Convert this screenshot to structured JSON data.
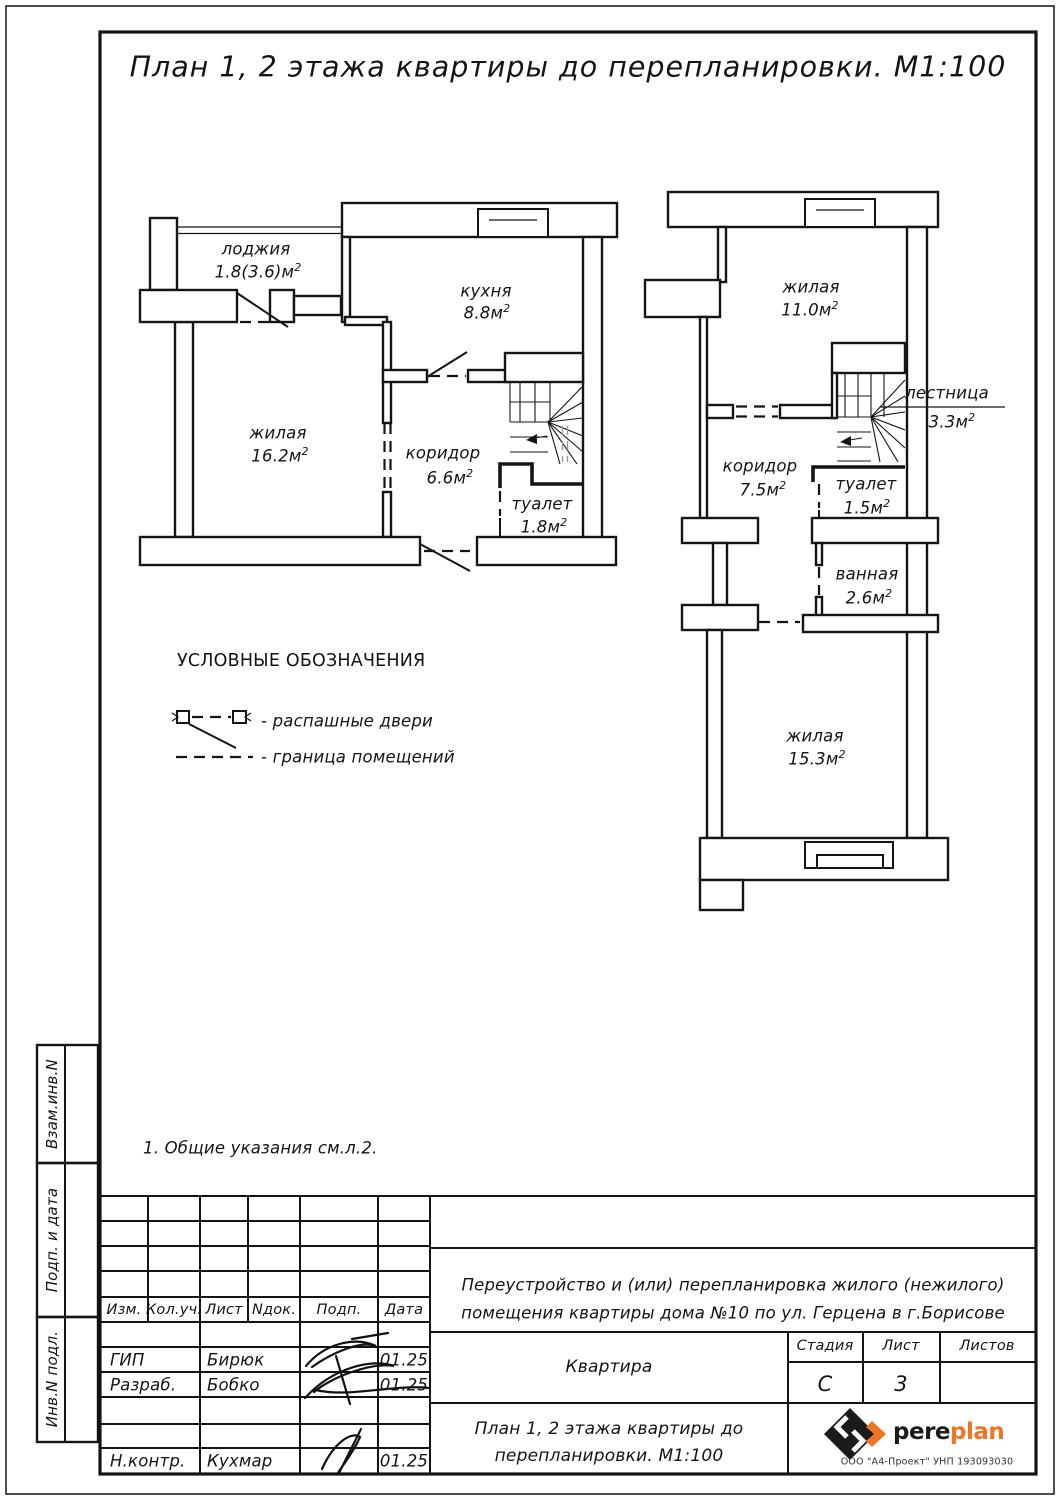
{
  "sup": "2",
  "title": "План 1, 2 этажа квартиры до перепланировки. М1:100",
  "note": "1. Общие указания см.л.2.",
  "legend": {
    "title": "УСЛОВНЫЕ ОБОЗНАЧЕНИЯ",
    "doors": "- распашные двери",
    "boundary": "- граница помещений"
  },
  "floor1": {
    "rooms": {
      "loggia": {
        "name": "лоджия",
        "area": "1.8(3.6)м"
      },
      "kitchen": {
        "name": "кухня",
        "area": "8.8м"
      },
      "living": {
        "name": "жилая",
        "area": "16.2м"
      },
      "corridor": {
        "name": "коридор",
        "area": "6.6м"
      },
      "wc": {
        "name": "туалет",
        "area": "1.8м"
      }
    }
  },
  "floor2": {
    "rooms": {
      "living": {
        "name": "жилая",
        "area": "11.0м"
      },
      "stairs": {
        "name": "лестница",
        "area": "3.3м"
      },
      "corridor": {
        "name": "коридор",
        "area": "7.5м"
      },
      "wc": {
        "name": "туалет",
        "area": "1.5м"
      },
      "bath": {
        "name": "ванная",
        "area": "2.6м"
      },
      "living2": {
        "name": "жилая",
        "area": "15.3м"
      }
    }
  },
  "stamp": {
    "cols": {
      "izm": "Изм.",
      "kol": "Кол.уч.",
      "list": "Лист",
      "ndok": "Nдок.",
      "podp": "Подп.",
      "data": "Дата"
    },
    "rows": {
      "gip": {
        "role": "ГИП",
        "name": "Бирюк",
        "date": "01.25"
      },
      "razrab": {
        "role": "Разраб.",
        "name": "Бобко",
        "date": "01.25"
      },
      "nkontr": {
        "role": "Н.контр.",
        "name": "Кухмар",
        "date": "01.25"
      }
    },
    "project_line1": "Переустройство и (или) перепланировка жилого (нежилого)",
    "project_line2": "помещения квартиры дома №10 по ул. Герцена в г.Борисове",
    "object": "Квартира",
    "stage_label": "Стадия",
    "stage": "С",
    "sheet_label": "Лист",
    "sheet": "3",
    "sheets_label": "Листов",
    "drawing_line1": "План 1, 2 этажа квартиры до",
    "drawing_line2": "перепланировки. М1:100",
    "brand": {
      "black": "pere",
      "orange": "plan",
      "company": "ООО \"А4-Проект\" УНП 193093030"
    }
  },
  "side": {
    "a": "Взам.инв.N",
    "b": "Подп. и дата",
    "c": "Инв.N подл."
  },
  "colors": {
    "ink": "#141414",
    "accent": "#EE7623"
  }
}
